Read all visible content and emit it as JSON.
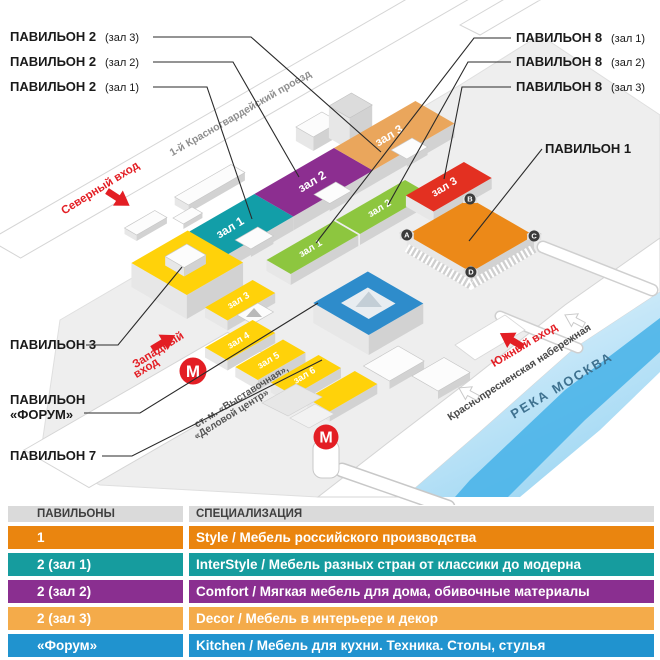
{
  "map": {
    "callouts": {
      "p2h3_bold": "ПАВИЛЬОН 2",
      "p2h3_note": "(зал 3)",
      "p2h2_bold": "ПАВИЛЬОН 2",
      "p2h2_note": "(зал 2)",
      "p2h1_bold": "ПАВИЛЬОН 2",
      "p2h1_note": "(зал 1)",
      "p8h1_bold": "ПАВИЛЬОН 8",
      "p8h1_note": "(зал 1)",
      "p8h2_bold": "ПАВИЛЬОН 8",
      "p8h2_note": "(зал 2)",
      "p8h3_bold": "ПАВИЛЬОН 8",
      "p8h3_note": "(зал 3)",
      "p1": "ПАВИЛЬОН 1",
      "p3": "ПАВИЛЬОН 3",
      "forum_line1": "ПАВИЛЬОН",
      "forum_line2": "«ФОРУМ»",
      "p7": "ПАВИЛЬОН 7"
    },
    "halls": {
      "t1": "зал 1",
      "t2": "зал 2",
      "t3": "зал 3",
      "g1": "зал 1",
      "g2": "зал 2",
      "r3": "зал 3",
      "y3": "зал 3",
      "y4": "зал 4",
      "y5": "зал 5",
      "y6": "зал 6"
    },
    "streets": {
      "north_road": "1-й Красногвардейский проезд",
      "embankment": "Краснопресненская набережная",
      "river": "РЕКА МОСКВА",
      "metro_line1": "ст. м. «Выставочная»,",
      "metro_line2": "«Деловой центр»"
    },
    "entrances": {
      "north": "Северный вход",
      "west_line1": "Западный",
      "west_line2": "вход",
      "south": "Южный вход"
    },
    "metro_letter": "М",
    "pav1_corners": {
      "a": "A",
      "b": "B",
      "c": "C",
      "d": "D"
    },
    "colors": {
      "pav1": "#EC8918",
      "pav2_h1": "#129EA8",
      "pav2_h2": "#8C2E90",
      "pav2_h3": "#EAA65C",
      "pav8_green": "#8DC63F",
      "pav8_h3": "#E33021",
      "yellow": "#FFD20A",
      "forum": "#2E8CCB",
      "metro": "#E31E24",
      "river": "#45B2E8"
    }
  },
  "table": {
    "headers": [
      "ПАВИЛЬОНЫ",
      "СПЕЦИАЛИЗАЦИЯ"
    ],
    "rows": [
      {
        "pavilion": "1",
        "spec": "Style / Мебель российского производства",
        "color": "#EA850F"
      },
      {
        "pavilion": "2 (зал 1)",
        "spec": "InterStyle / Мебель разных стран от классики до модерна",
        "color": "#169C9E"
      },
      {
        "pavilion": "2 (зал 2)",
        "spec": "Comfort / Мягкая мебель для дома, обивочные материалы",
        "color": "#8A2F90"
      },
      {
        "pavilion": "2 (зал 3)",
        "spec": "Decor / Мебель в интерьере и декор",
        "color": "#F4AB4A"
      },
      {
        "pavilion": "«Форум»",
        "spec": "Kitchen / Мебель для кухни. Техника. Столы, стулья",
        "color": "#2093CF"
      }
    ],
    "next_row_color": "#F2A430"
  }
}
